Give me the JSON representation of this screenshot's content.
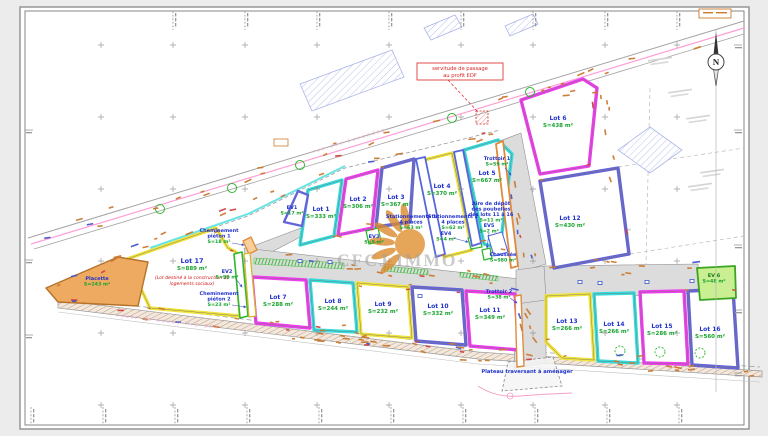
{
  "watermark": "CFCJ IMMO",
  "north_label": "N",
  "notes": {
    "servitude_line1": "servitude de passage",
    "servitude_line2": "au profit EDF",
    "plateau": "Plateau traversant à aménager",
    "road_top": "rue des Lavandes",
    "road_bottom": "route de Louey  R.D 654",
    "social_note_line1": "(Lot destiné à la construction de",
    "social_note_line2": "logements sociaux)"
  },
  "colors": {
    "magenta": "#ee3cee",
    "cyan": "#35dbdb",
    "yellow": "#f0e33a",
    "violet": "#6565d8",
    "green": "#2eb82e",
    "path_orange": "#e08a3c",
    "label_blue": "#2233cc",
    "area_green": "#18a32e",
    "note_red": "#d02020"
  },
  "lots": [
    {
      "name": "Lot 1",
      "area": "S=333 m²",
      "color": "cyan"
    },
    {
      "name": "Lot 2",
      "area": "S=306 m²",
      "color": "magenta"
    },
    {
      "name": "Lot 3",
      "area": "S=367 m²",
      "color": "violet"
    },
    {
      "name": "Lot 4",
      "area": "S=370 m²",
      "color": "yellow"
    },
    {
      "name": "Lot 5",
      "area": "S=667 m²",
      "color": "cyan"
    },
    {
      "name": "Lot 6",
      "area": "S=438 m²",
      "color": "magenta"
    },
    {
      "name": "Lot 7",
      "area": "S=288 m²",
      "color": "magenta"
    },
    {
      "name": "Lot 8",
      "area": "S=244 m²",
      "color": "cyan"
    },
    {
      "name": "Lot 9",
      "area": "S=232 m²",
      "color": "yellow"
    },
    {
      "name": "Lot 10",
      "area": "S=332 m²",
      "color": "violet"
    },
    {
      "name": "Lot 11",
      "area": "S=349 m²",
      "color": "magenta"
    },
    {
      "name": "Lot 12",
      "area": "S=430 m²",
      "color": "violet"
    },
    {
      "name": "Lot 13",
      "area": "S=266 m²",
      "color": "yellow"
    },
    {
      "name": "Lot 14",
      "area": "S=266 m²",
      "color": "cyan"
    },
    {
      "name": "Lot 15",
      "area": "S=286 m²",
      "color": "magenta"
    },
    {
      "name": "Lot 16",
      "area": "S=560 m²",
      "color": "violet"
    },
    {
      "name": "Lot 17",
      "area": "S=889 m²",
      "color": "yellow"
    }
  ],
  "features": {
    "placette": {
      "lines": [
        "Placette"
      ],
      "area": "S=243 m²"
    },
    "ev1": {
      "lines": [
        "EV1"
      ],
      "area": "S=17 m²"
    },
    "ev2": {
      "lines": [
        "EV2"
      ],
      "area": "S=90 m²"
    },
    "ev3": {
      "lines": [
        "EV3"
      ],
      "area": "S=5 m²"
    },
    "ev4": {
      "lines": [
        "EV4"
      ],
      "area": "S=4 m²"
    },
    "ev5": {
      "lines": [
        "EV5"
      ],
      "area": "S=2 m²"
    },
    "ev6": {
      "lines": [
        "EV 6"
      ],
      "area": "S=48 m²"
    },
    "trottoir1": {
      "lines": [
        "Trottoir 1"
      ],
      "area": "S=59 m²"
    },
    "trottoir2": {
      "lines": [
        "Trottoir 2"
      ],
      "area": "S=38 m²"
    },
    "chem1": {
      "lines": [
        "Cheminement",
        "piéton 1"
      ],
      "area": "S=18 m²"
    },
    "chem2": {
      "lines": [
        "Cheminement",
        "piéton 2"
      ],
      "area": "S=23 m²"
    },
    "stat1": {
      "lines": [
        "Stationnements 1",
        "4 places"
      ],
      "area": "S=63 m²"
    },
    "stat2": {
      "lines": [
        "Stationnements 2",
        "4 places"
      ],
      "area": "S=62 m²"
    },
    "aire": {
      "lines": [
        "Aire de dépôt",
        "des poubelles",
        "des lots 11 à 16"
      ],
      "area": "S=11 m²"
    },
    "chaussee": {
      "lines": [
        "Chaussée"
      ],
      "area": "S=980 m²"
    }
  }
}
